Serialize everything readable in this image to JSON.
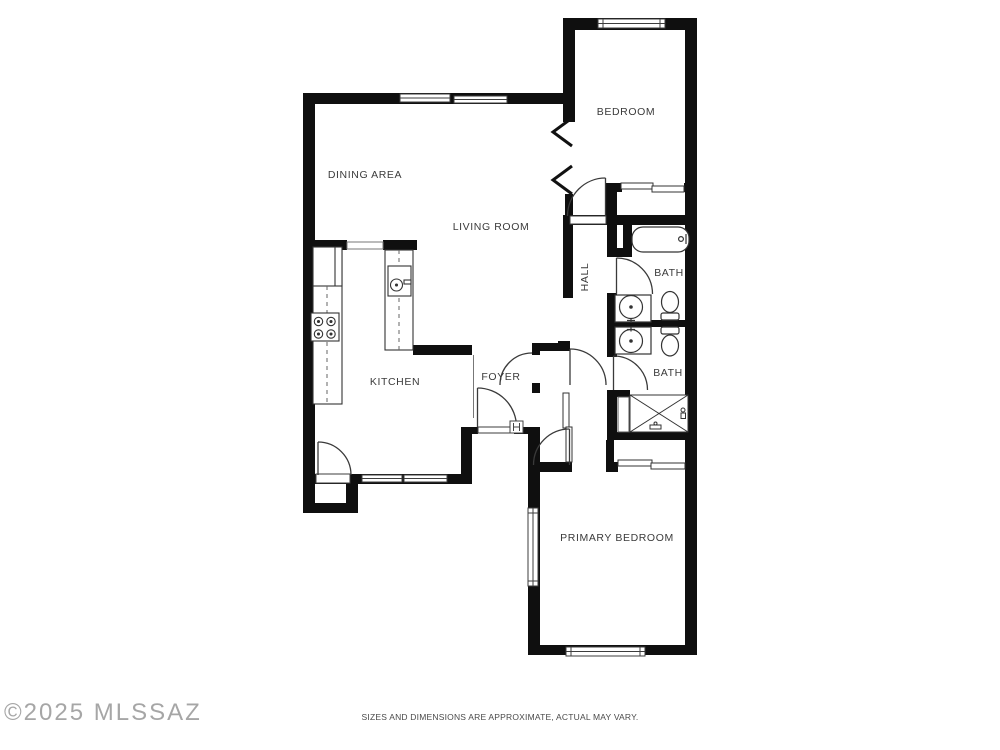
{
  "floor_plan": {
    "rooms": [
      {
        "id": "bedroom",
        "label": "BEDROOM",
        "x": 626,
        "y": 112,
        "rotated": false
      },
      {
        "id": "dining-area",
        "label": "DINING AREA",
        "x": 365,
        "y": 175,
        "rotated": false
      },
      {
        "id": "living-room",
        "label": "LIVING ROOM",
        "x": 491,
        "y": 227,
        "rotated": false
      },
      {
        "id": "hall",
        "label": "HALL",
        "x": 585,
        "y": 277,
        "rotated": true
      },
      {
        "id": "bath-1",
        "label": "BATH",
        "x": 669,
        "y": 273,
        "rotated": false
      },
      {
        "id": "kitchen",
        "label": "KITCHEN",
        "x": 395,
        "y": 382,
        "rotated": false
      },
      {
        "id": "foyer",
        "label": "FOYER",
        "x": 501,
        "y": 377,
        "rotated": false
      },
      {
        "id": "bath-2",
        "label": "BATH",
        "x": 668,
        "y": 373,
        "rotated": false
      },
      {
        "id": "primary-bedroom",
        "label": "PRIMARY BEDROOM",
        "x": 617,
        "y": 538,
        "rotated": false
      }
    ]
  },
  "watermark": {
    "text": "©2025 MLSSAZ"
  },
  "footer": {
    "disclaimer": "SIZES AND DIMENSIONS ARE APPROXIMATE, ACTUAL MAY VARY."
  },
  "colors": {
    "wall": "#0f0f0f",
    "fixture_line": "#333333",
    "door_line": "#3a3a3a",
    "window_line": "#3d3d3d",
    "background": "#ffffff",
    "label": "#3b3b3b",
    "watermark": "#979797",
    "disclaimer": "#4a4a4a"
  }
}
